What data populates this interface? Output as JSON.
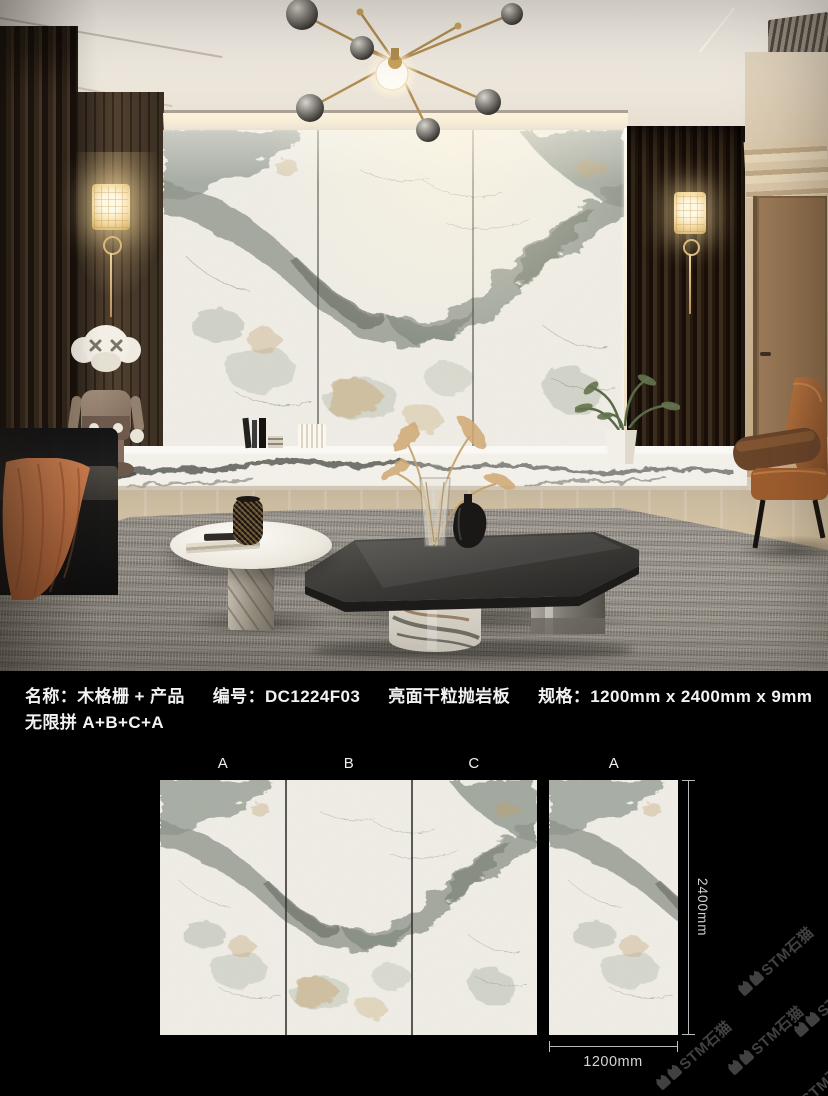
{
  "info_bar": {
    "name": "名称：木格栅 + 产品",
    "code": "编号：DC1224F03",
    "finish": "亮面干粒抛岩板",
    "spec": "规格：1200mm x 2400mm x 9mm",
    "combo": "无限拼 A+B+C+A"
  },
  "slabs": {
    "group_labels": [
      "A",
      "B",
      "C"
    ],
    "single_label": "A",
    "height_dim": "2400mm",
    "width_dim": "1200mm"
  },
  "watermark": {
    "text": "STM石猫"
  },
  "colors": {
    "background": "#000000",
    "info_text": "#f2f2f2",
    "dim_line": "#bababa",
    "watermark_text": "#414141",
    "marble_base": "#f1efe7",
    "marble_vein": "#8e948a",
    "marble_gold": "#c9a873",
    "wood_slat": "#34271c",
    "leather_chair": "#9c5a33",
    "throw_blanket": "#b5693f",
    "rug": "#99938a",
    "table_top": "#3b3a37",
    "brass": "#b18d52"
  }
}
